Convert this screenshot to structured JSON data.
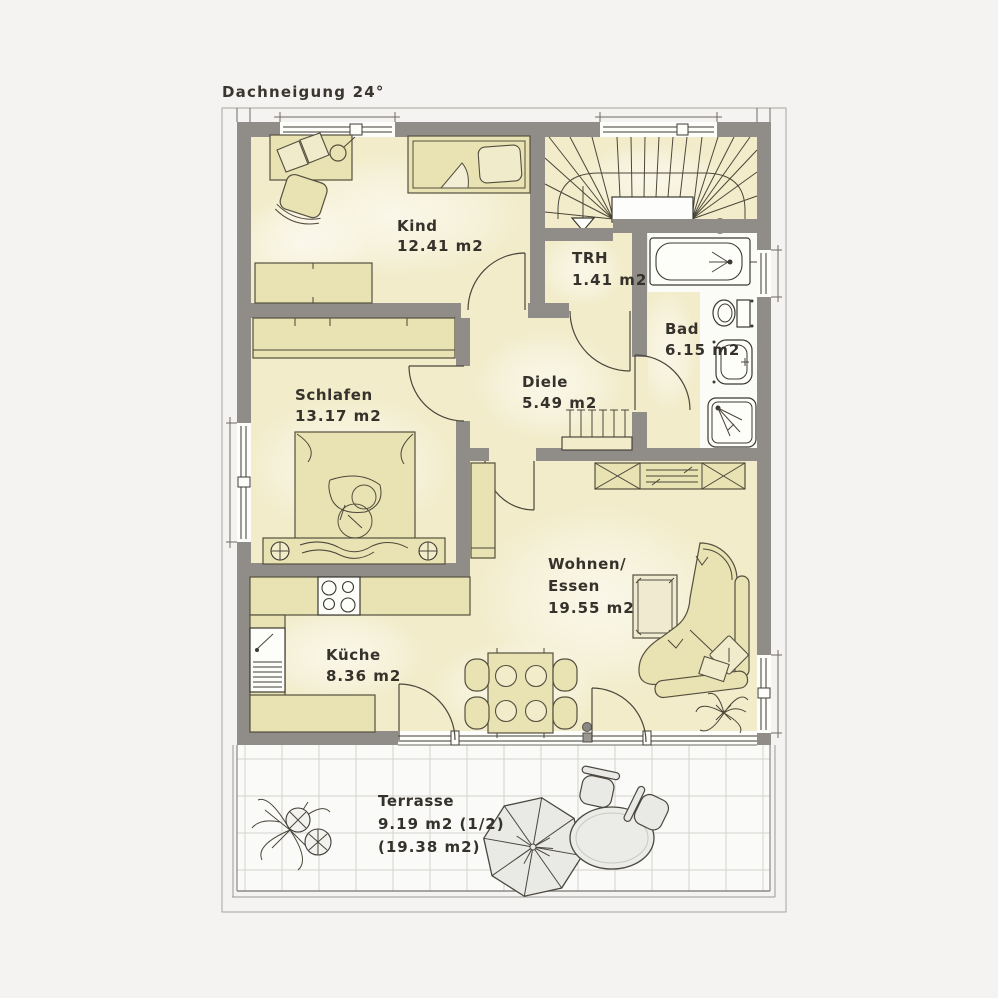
{
  "plan_title": "Dachneigung 24°",
  "rooms": {
    "kind": {
      "name": "Kind",
      "area": "12.41 m2"
    },
    "trh": {
      "name": "TRH",
      "area": "1.41 m2"
    },
    "bad": {
      "name": "Bad",
      "area": "6.15 m2"
    },
    "schlafen": {
      "name": "Schlafen",
      "area": "13.17 m2"
    },
    "diele": {
      "name": "Diele",
      "area": "5.49 m2"
    },
    "wohnen": {
      "name_line1": "Wohnen/",
      "name_line2": "Essen",
      "area": "19.55 m2"
    },
    "kueche": {
      "name": "Küche",
      "area": "8.36 m2"
    },
    "terrasse": {
      "name": "Terrasse",
      "area_line1": "9.19 m2 (1/2)",
      "area_line2": "(19.38 m2)"
    }
  },
  "colors": {
    "background": "#f4f3f1",
    "floor": "#f2ecca",
    "wall": "#908d88",
    "furniture": "#e9e2b2",
    "fixture_white": "#fdfdfa",
    "terrace_floor": "#fafaf8",
    "line": "#4c473b",
    "text": "#35312b"
  }
}
